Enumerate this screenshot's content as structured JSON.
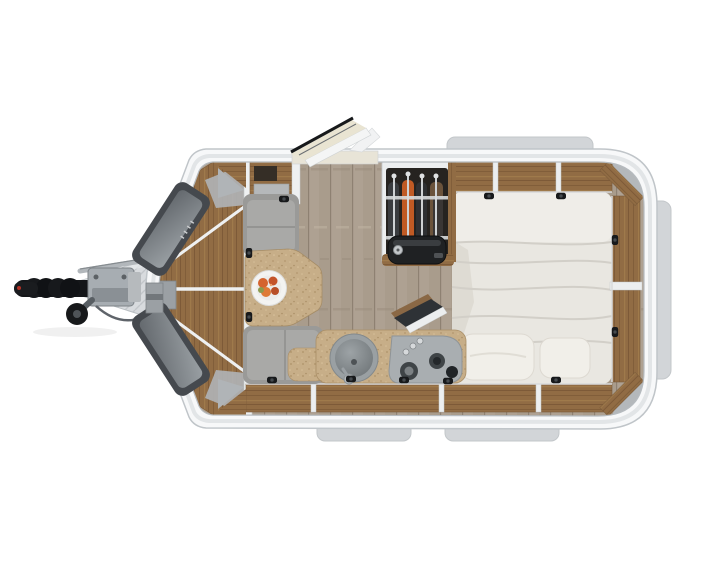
{
  "scene": {
    "type": "floorplan-render",
    "description": "Top-down 3D rendering of a compact teardrop travel trailer floor plan: front V-nose with hitch at left, dinette with table and fruit plate, kitchenette with sink and two-burner cooktop, open wardrobe with hanging clothes and duffel bag, large bed at rear surrounded by wood storage compartments, open entry door at top.",
    "background": "#ffffff"
  },
  "colors": {
    "shell": "#f7f8f9",
    "shellRim": "#c0c5c9",
    "tab": "#d2d5d8",
    "floorBase": "#a99c8c",
    "woodBase": "#916c44",
    "counterBase": "#c7ae88",
    "plateBase": "#d8dbde",
    "bed": "#e9e7e1",
    "pillow": "#f1efe9",
    "bench": "#9a9a98",
    "benchCushion": "#a9a9a7",
    "wardrobeInterior": "#262320",
    "clothesOrange": "#c05a24",
    "cooktop": "#a9aeb1",
    "sink": "#9aa0a3",
    "doorCream": "#e9e4d2",
    "hitchBlack": "#141619",
    "windowFrame": "#45494e",
    "windowGlass": "#70757a",
    "grayPad": "#b2b6b9",
    "dinnerPlate": "#f3f3f1",
    "fruitOrange": "#d4642f"
  },
  "parts": [
    {
      "name": "hitch-coupler",
      "desc": "black ribbed coupler with jockey wheel"
    },
    {
      "name": "tongue-plate",
      "desc": "diamond-plate A-frame drawbar"
    },
    {
      "name": "nose-windows",
      "desc": "two dark tinted windows on angled front faces"
    },
    {
      "name": "entry-door-open",
      "desc": "entry door swung open through top wall"
    },
    {
      "name": "dinette",
      "desc": "two grey bench seats with wood table and fruit plate"
    },
    {
      "name": "kitchenette",
      "desc": "counter with round sink, cooktop with open glass lid"
    },
    {
      "name": "wardrobe",
      "desc": "open closet with four hangers and duffel bag"
    },
    {
      "name": "bed",
      "desc": "double bed with duvet and two pillows"
    },
    {
      "name": "storage-ring",
      "desc": "wood storage compartments with latches along walls"
    },
    {
      "name": "window-tabs",
      "desc": "exterior window bumps on top, right and bottom walls"
    }
  ],
  "counts": {
    "wardrobe_hangers": 4,
    "bed_pillows": 2,
    "cooktop_burners": 2,
    "cooktop_knobs": 3,
    "bottom_tabs": 2
  }
}
